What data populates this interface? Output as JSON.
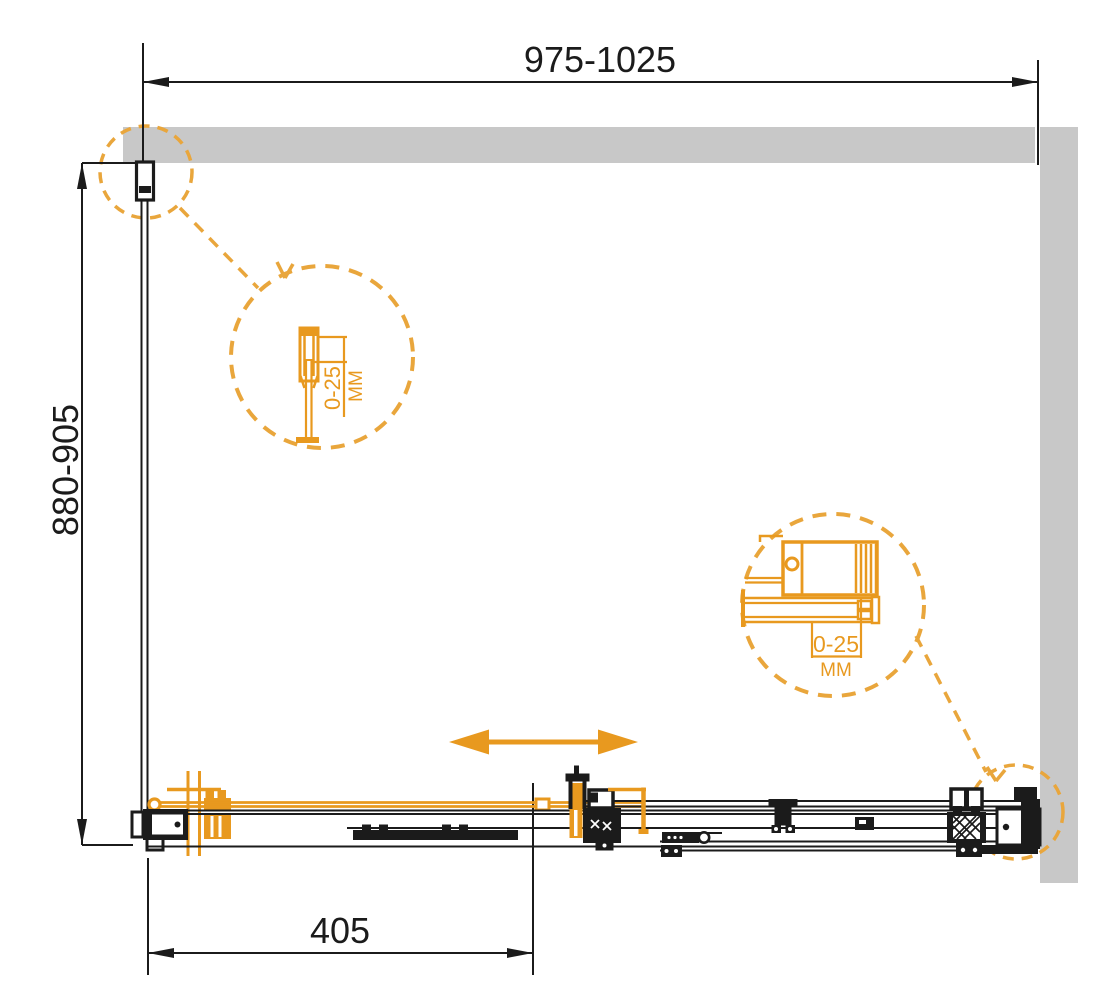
{
  "drawing": {
    "dimensions": {
      "width_range": "975-1025",
      "depth_range": "880-905",
      "door_opening": "405"
    },
    "details": {
      "top_left": {
        "adjustment_range": "0-25",
        "unit": "MM"
      },
      "right": {
        "adjustment_range": "0-25",
        "unit": "MM"
      }
    },
    "colors": {
      "accent_orange": "#E8991F",
      "callout_orange": "#E9A63C",
      "wall_gray": "#C8C8C8",
      "line_black": "#1B1B1B"
    },
    "icons": {
      "slide_arrow": "double-headed-horizontal-arrow"
    }
  }
}
